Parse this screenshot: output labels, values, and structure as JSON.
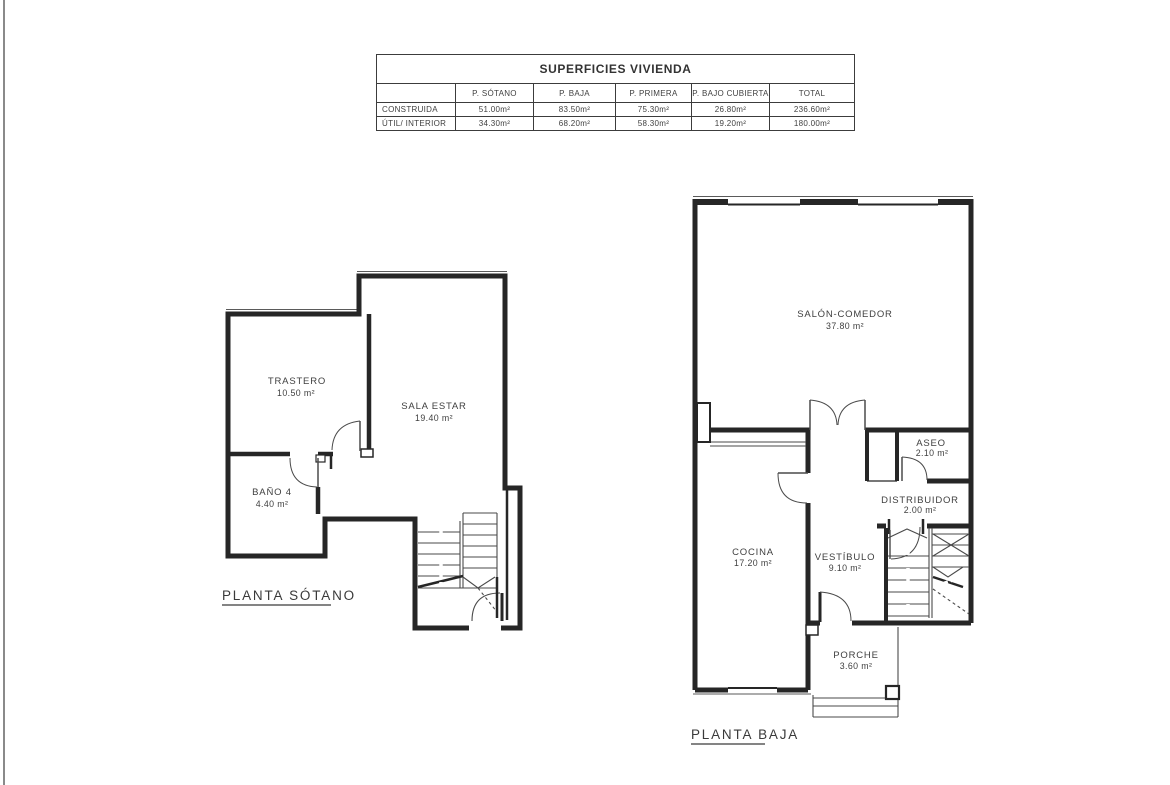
{
  "style": {
    "ink": "#3a3a3a",
    "wall": "#262626",
    "thin_line": "#4a4a4a",
    "edge_line": "#8a8a8a",
    "background": "#ffffff"
  },
  "table": {
    "title": "SUPERFICIES VIVIENDA",
    "columns": [
      "",
      "P. SÓTANO",
      "P. BAJA",
      "P. PRIMERA",
      "P. BAJO CUBIERTA",
      "TOTAL"
    ],
    "rows": [
      {
        "label": "CONSTRUIDA",
        "values": [
          "51.00m²",
          "83.50m²",
          "75.30m²",
          "26.80m²",
          "236.60m²"
        ]
      },
      {
        "label": "ÚTIL/ INTERIOR",
        "values": [
          "34.30m²",
          "68.20m²",
          "58.30m²",
          "19.20m²",
          "180.00m²"
        ]
      }
    ]
  },
  "plans": {
    "sotano": {
      "label": "PLANTA SÓTANO",
      "rooms": {
        "trastero": {
          "name": "TRASTERO",
          "area": "10.50 m²"
        },
        "sala_estar": {
          "name": "SALA ESTAR",
          "area": "19.40 m²"
        },
        "bano4": {
          "name": "BAÑO 4",
          "area": "4.40 m²"
        }
      }
    },
    "baja": {
      "label": "PLANTA BAJA",
      "rooms": {
        "salon_comedor": {
          "name": "SALÓN-COMEDOR",
          "area": "37.80 m²"
        },
        "aseo": {
          "name": "ASEO",
          "area": "2.10 m²"
        },
        "distribuidor": {
          "name": "DISTRIBUIDOR",
          "area": "2.00 m²"
        },
        "cocina": {
          "name": "COCINA",
          "area": "17.20 m²"
        },
        "vestibulo": {
          "name": "VESTÍBULO",
          "area": "9.10 m²"
        },
        "porche": {
          "name": "PORCHE",
          "area": "3.60 m²"
        }
      }
    }
  }
}
